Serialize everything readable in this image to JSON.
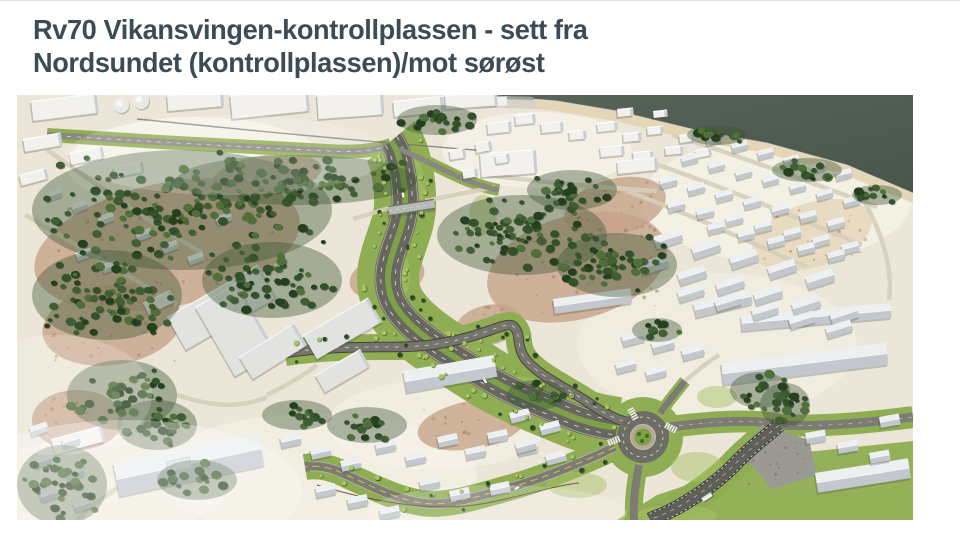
{
  "title": {
    "line1": "Rv70 Vikansvingen-kontrollplassen - sett fra",
    "line2": "Nordsundet (kontrollplassen)/mot sørøst"
  },
  "figure": {
    "label": "aerial-3d-road-visualization",
    "features": [
      "sea",
      "shoreline",
      "harbour-quay",
      "coniferous-forest",
      "rocky-terrain",
      "divided-highway-with-green-median",
      "overpass-bridge",
      "ramp-bridge",
      "road-cutting",
      "roundabout",
      "pedestrian-crossings",
      "residential-houses",
      "industrial-buildings",
      "warehouses",
      "bus"
    ],
    "palette": {
      "water": "#57645a",
      "water_deep": "#4a564c",
      "sand": "#e6d6b8",
      "terrain": "#ece6d8",
      "terrain_light": "#f7f3ea",
      "rock": "#c7a48a",
      "rock_speckle": "#a3775c",
      "forest_dark": "#24401f",
      "forest": "#33522c",
      "forest_mid": "#3f5e33",
      "forest_light": "#4f7039",
      "grass": "#8fae53",
      "grass_light": "#a9c268",
      "asphalt": "#67675f",
      "asphalt_light": "#7d7c72",
      "road_pale": "#d6cebc",
      "marking": "#e9e8dc",
      "marking_yellow": "#d3c052",
      "median": "#7da049",
      "bridge_edge": "#4a4338",
      "bridge_deck": "#b6b9b5",
      "wall": "#47463f",
      "rockcut": "#9a9a92",
      "building": "#f2f1ed",
      "building_shade": "#c9ced4",
      "roof_lit": "#edeff0",
      "roof_shade": "#c2c8ce",
      "inst": "#e2e3e1",
      "fence": "#5a3524",
      "shadow": "rgba(70,75,60,0.28)"
    }
  }
}
